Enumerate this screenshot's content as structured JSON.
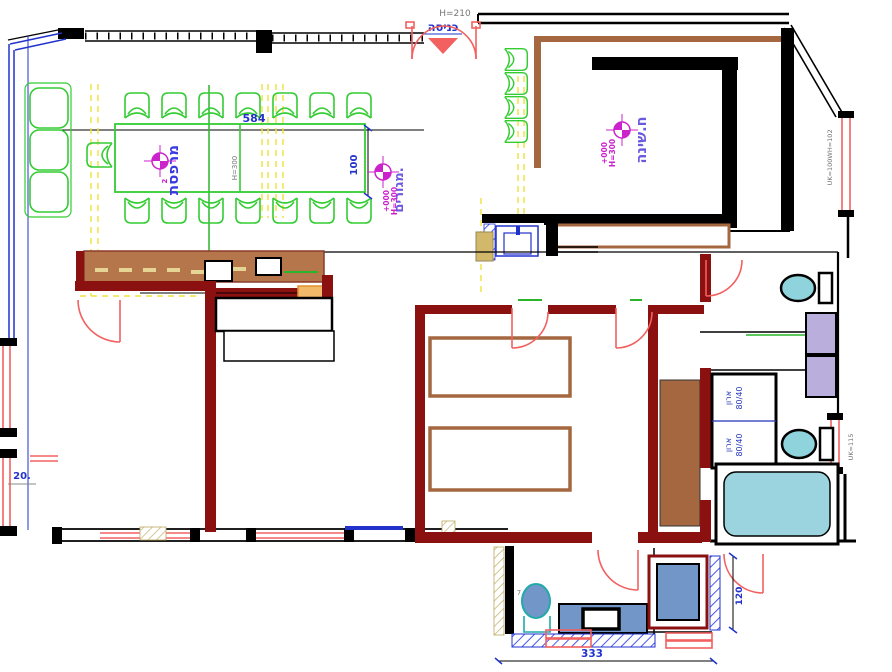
{
  "plan": {
    "entrance": {
      "label": "כניסה",
      "opening_height": "H=210"
    },
    "terrace": {
      "room_label": "מרפסת",
      "zone_label": "מגורים.",
      "table_length": "584",
      "table_width": "100",
      "table_height": "H=300",
      "marker_index": "2"
    },
    "bedroom": {
      "room_label": "ח.שינה"
    },
    "level_marker": {
      "level": "+000",
      "height": "H=300"
    },
    "closet": {
      "label": "ארון",
      "size": "80/40"
    },
    "dims": {
      "left": "20.",
      "bottom": "333",
      "shower": "120"
    },
    "window_tags": {
      "top": "WH=102",
      "upper": "UK=100",
      "lower": "UK=115"
    },
    "notes": {
      "toilet": "7"
    }
  },
  "colors": {
    "wall": "#000000",
    "partition": "#8B1010",
    "wood": "#A5673F",
    "counter": "#B5764B",
    "furniture_green": "#33CC33",
    "dimension_blue": "#2233CC",
    "marker_magenta": "#CC22CC",
    "label_violet": "#6A5ADF",
    "door_salmon": "#F26060",
    "fixture_cyan": "#8FD4DC",
    "fixture_blue": "#7296C8",
    "cabinet_lavender": "#B9AEDC",
    "tub_cyan": "#9BD4DE",
    "guide_yellow": "#F0E23C",
    "accent_orange": "#F2B96B",
    "hatch_blue": "#3344EE",
    "annotation_gray": "#777777"
  }
}
